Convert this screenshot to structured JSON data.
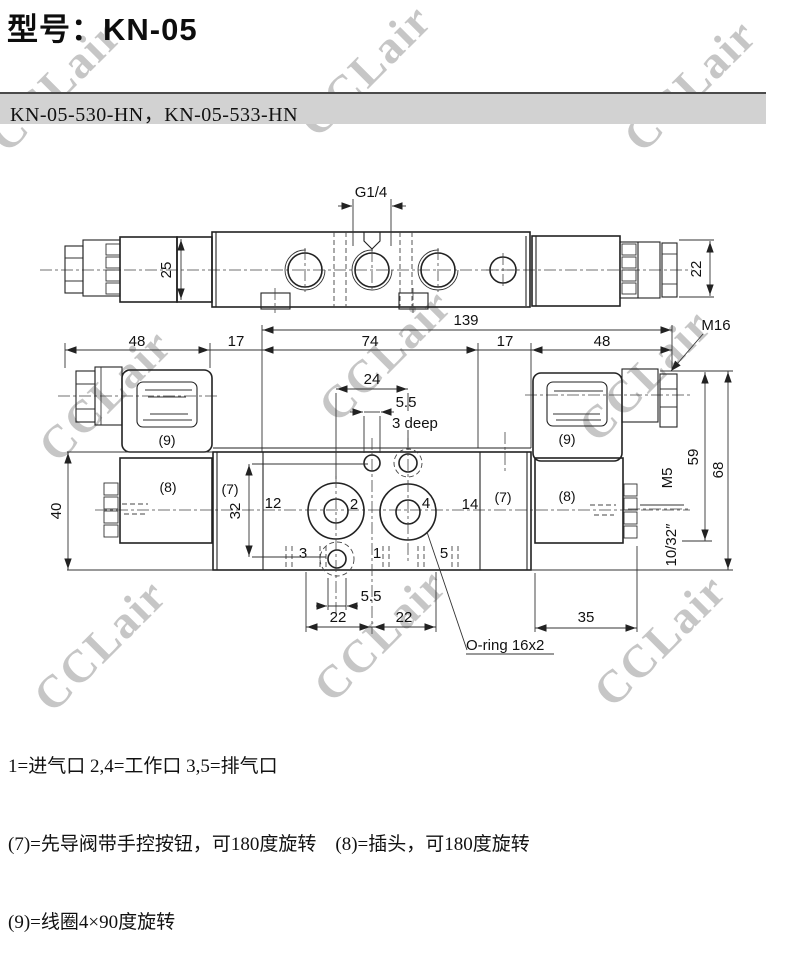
{
  "title": "型号：KN-05",
  "subtitle": "KN-05-530-HN，KN-05-533-HN",
  "watermark_text": "CCLair",
  "colors": {
    "band_bg": "#d2d2d2",
    "line": "#222222",
    "watermark": "#c6c6c6"
  },
  "top_view": {
    "thread_label": "G1/4",
    "dim_height": "25",
    "dim_coil_height": "22"
  },
  "dims": {
    "d48_left": "48",
    "d17_left": "17",
    "d74": "74",
    "d17_right": "17",
    "d48_right": "48",
    "d139": "139",
    "m16": "M16",
    "d24": "24",
    "d55_top": "5.5",
    "depth_note": "3 deep",
    "d40": "40",
    "d32": "32",
    "d12": "12",
    "d14": "14",
    "d55_bottom": "5.5",
    "d22_left": "22",
    "d22_right": "22",
    "d35": "35",
    "d59": "59",
    "d68": "68",
    "m5": "M5",
    "thread_imperial": "10/32″",
    "oring": "O-ring 16x2"
  },
  "part_labels": {
    "pilot_left": "(7)",
    "pilot_right": "(7)",
    "coil_left": "(8)",
    "coil_right": "(8)",
    "plug_left": "(9)",
    "plug_right": "(9)"
  },
  "port_labels": {
    "p1": "1",
    "p2": "2",
    "p3": "3",
    "p4": "4",
    "p5": "5"
  },
  "legend": {
    "line1": "1=进气口 2,4=工作口 3,5=排气口",
    "line2": "(7)=先导阀带手控按钮，可180度旋转　(8)=插头，可180度旋转",
    "line3": "(9)=线圈4×90度旋转"
  }
}
